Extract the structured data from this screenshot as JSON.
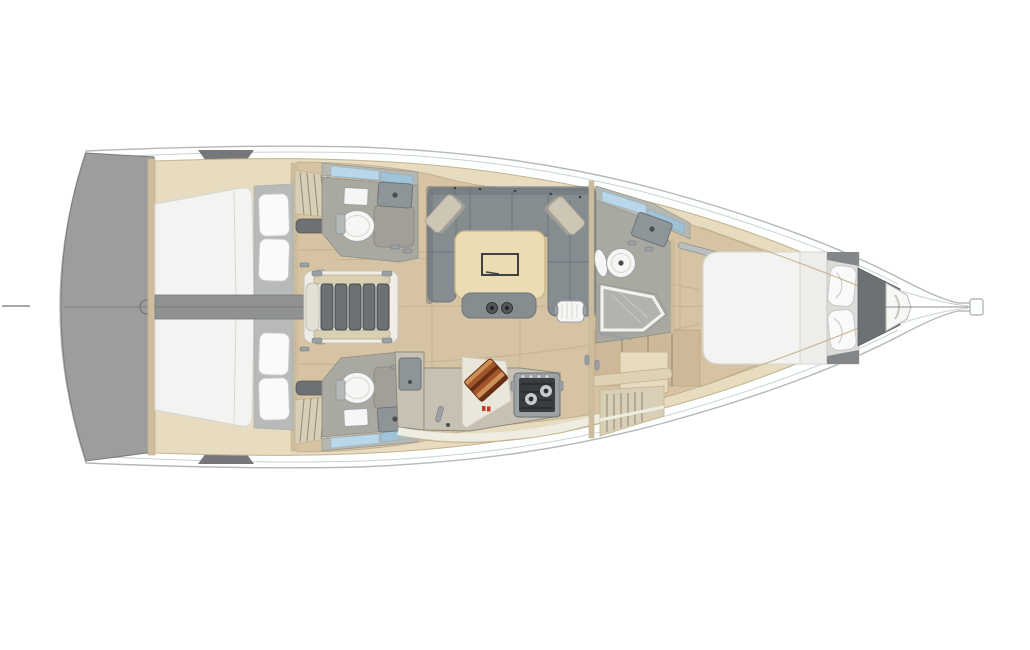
{
  "palette": {
    "hull-fill": "#feffff",
    "hull-line": "#b5b8ba",
    "inner-line": "#cdd0d2",
    "lining": "#e7dcc0",
    "lining-edge": "#c3b38e",
    "wood-floor": "#d5c3a3",
    "wood-seam": "#bcab8b",
    "platform-gray": "#9c9d9d",
    "platform-edge": "#7b7b7b",
    "centerline": "#767676",
    "dark-wedge": "#75777a",
    "bulkhead-wood": "#cdbd9c",
    "mattress": "#f3f3f1",
    "mattress-edge": "#d8d8d4",
    "pillow": "#fafafa",
    "pillow-shadow": "#c8c8c6",
    "bedhead-gray": "#b7bab9",
    "wardrobe": "#d9cfb6",
    "wardrobe-slat": "#93897a",
    "bench-dark": "#6e7173",
    "corridor-gray": "#8f9192",
    "stair-base": "#efede6",
    "stair-rail": "#d9d0b4",
    "stair-tread": "#6d7173",
    "stair-dark": "#43474a",
    "head-floor": "#a9a8a1",
    "cabinet-gray": "#b7b7b1",
    "window-blue": "#b9d7e8",
    "window-blue2": "#9fc4da",
    "fixture-white": "#f6f6f4",
    "fixture-line": "#9fa3a4",
    "sink-gray": "#8e9598",
    "shower-panel": "#a19f98",
    "sofa-gray": "#868d91",
    "sofa-dark": "#6f767b",
    "sofa-seam": "#5f666b",
    "cushion-tan": "#cdc6b5",
    "cushion-shadow": "#a9a399",
    "table-wood": "#ecdcb3",
    "table-edge": "#c9b687",
    "table-inlay": "#3f4142",
    "cup-dark": "#55595c",
    "galley-counter": "#c6c1b2",
    "galley-edge": "#8e897b",
    "counter-white": "#eae6da",
    "stove-frame": "#9ba1a4",
    "stove-dark": "#3a3d3f",
    "glass-gray": "#b3b5b2",
    "anchor-dark": "#6e7174",
    "hardware": "#9aa0a4",
    "red-mark": "#c43a2a"
  },
  "areas": {
    "plan": "sailboat-interior-floor-plan",
    "swim_platform": "stern-swim-platform",
    "aft_cabin_top": "aft-double-cabin-top",
    "aft_cabin_bottom": "aft-double-cabin-bottom",
    "engine_corridor": "engine-compartment-corridor",
    "companionway": "companionway-stairs",
    "head_top": "aft-head-top",
    "head_bottom": "aft-head-bottom",
    "salon": "salon-settee-and-table",
    "galley": "galley",
    "forward_head": "forward-head-with-shower",
    "forward_cabin": "forward-owner-cabin",
    "bow": "bow-and-bowsprit"
  }
}
